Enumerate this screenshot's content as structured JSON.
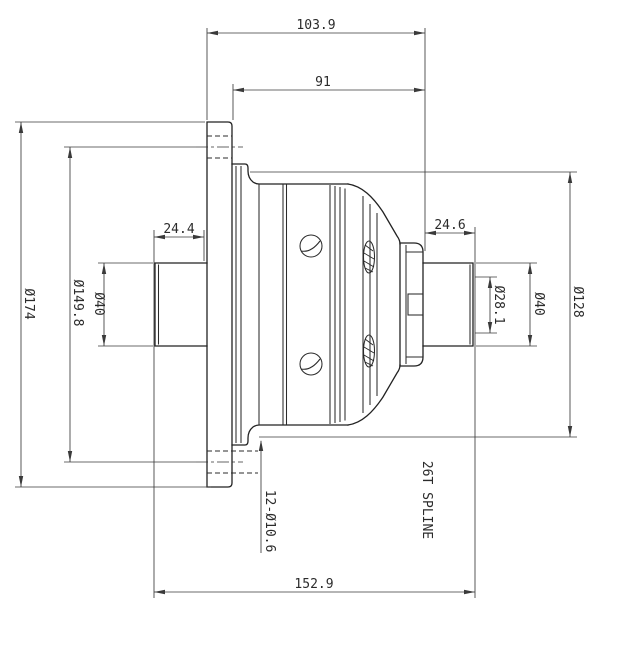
{
  "drawing": {
    "type": "mechanical-part-orthographic-section",
    "part": "differential-case",
    "colors": {
      "line": "#2b2b2b",
      "dimension": "#3a3a3a",
      "background": "#ffffff"
    },
    "dims": {
      "top_width": "103.9",
      "body_width": "91",
      "left_shaft_length": "24.4",
      "right_shaft_length": "24.6",
      "flange_diameter": "Ø174",
      "bolt_circle_diameter": "Ø149.8",
      "left_shaft_diameter": "Ø40",
      "bore_diameter": "Ø28.1",
      "right_shaft_diameter": "Ø40",
      "body_diameter": "Ø128",
      "bolt_holes_note": "12-Ø10.6",
      "spline_note": "26T SPLINE",
      "overall_length": "152.9"
    }
  }
}
